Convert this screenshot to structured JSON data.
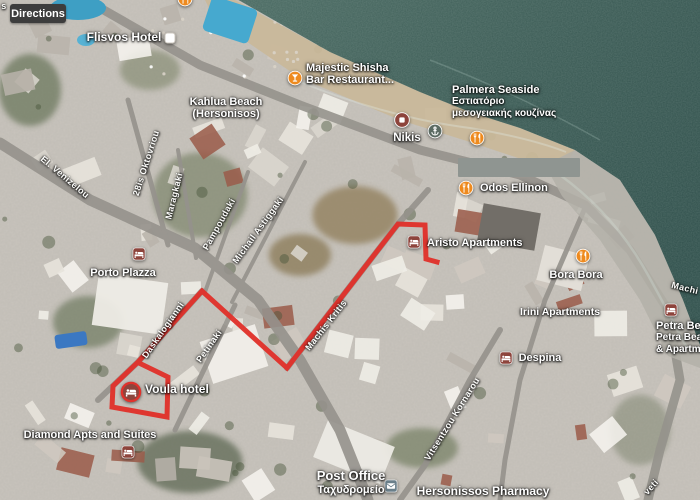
{
  "app": {
    "directions_button": "Directions"
  },
  "map": {
    "route": {
      "color": "#e0312b",
      "points": [
        [
          437,
          262
        ],
        [
          426,
          259
        ],
        [
          425,
          225
        ],
        [
          398,
          224
        ],
        [
          287,
          368
        ],
        [
          202,
          291
        ],
        [
          138,
          362
        ],
        [
          113,
          386
        ],
        [
          112,
          407
        ],
        [
          167,
          417
        ],
        [
          168,
          377
        ],
        [
          141,
          364
        ]
      ]
    },
    "redaction": {
      "x": 458,
      "y": 158,
      "w": 122,
      "h": 19
    },
    "pois": [
      {
        "id": "flisvos-hotel",
        "lines": [
          "Flisvos Hotel"
        ],
        "x": 124,
        "y": 31,
        "align": "center",
        "size": 12,
        "icon": "white-square-icon",
        "icon_x": 170,
        "icon_y": 38
      },
      {
        "id": "majestic-shisha-bar",
        "lines": [
          "Majestic Shisha",
          "Bar Restaurant..."
        ],
        "x": 306,
        "y": 62,
        "align": "left",
        "size": 11,
        "icon": "bar-icon",
        "icon_x": 295,
        "icon_y": 78
      },
      {
        "id": "kahlua-beach",
        "lines": [
          "Kahlua Beach",
          "(Hersonisos)"
        ],
        "x": 226,
        "y": 96,
        "align": "center",
        "size": 11
      },
      {
        "id": "palmera-seaside",
        "lines": [
          "Palmera Seaside",
          "Εστιατόριο",
          "μεσογειακής κουζίνας"
        ],
        "x": 452,
        "y": 84,
        "align": "left",
        "size": 11,
        "sub_from": 1,
        "icon": "restaurant-icon",
        "icon_x": 477,
        "icon_y": 138
      },
      {
        "id": "nikis",
        "lines": [
          "Nikis"
        ],
        "x": 407,
        "y": 132,
        "align": "center",
        "size": 11.5,
        "icon": "generic-poi-icon",
        "icon_x": 402,
        "icon_y": 120
      },
      {
        "id": "marina-poi",
        "lines": [],
        "x": 0,
        "y": 0,
        "icon": "anchor-poi-icon",
        "icon_x": 435,
        "icon_y": 131
      },
      {
        "id": "top-edge-poi",
        "lines": [],
        "x": 0,
        "y": 0,
        "icon": "restaurant-icon",
        "icon_x": 185,
        "icon_y": -1
      },
      {
        "id": "odos-ellinon",
        "lines": [
          "Odos Ellinon"
        ],
        "x": 480,
        "y": 182,
        "align": "left",
        "size": 11,
        "icon": "restaurant-icon",
        "icon_x": 466,
        "icon_y": 188
      },
      {
        "id": "aristo-apartments",
        "lines": [
          "Aristo Apartments"
        ],
        "x": 427,
        "y": 237,
        "align": "left",
        "size": 11,
        "icon": "lodging-icon",
        "icon_x": 414,
        "icon_y": 242
      },
      {
        "id": "porto-plazza",
        "lines": [
          "Porto Plazza"
        ],
        "x": 123,
        "y": 267,
        "align": "center",
        "size": 11,
        "icon": "lodging-icon",
        "icon_x": 139,
        "icon_y": 254
      },
      {
        "id": "bora-bora",
        "lines": [
          "Bora Bora"
        ],
        "x": 576,
        "y": 269,
        "align": "center",
        "size": 11,
        "icon": "restaurant-icon",
        "icon_x": 583,
        "icon_y": 256
      },
      {
        "id": "irini-apartments",
        "lines": [
          "Irini Apartments"
        ],
        "x": 560,
        "y": 307,
        "align": "center",
        "size": 10.5
      },
      {
        "id": "despina",
        "lines": [
          "Despina"
        ],
        "x": 540,
        "y": 352,
        "align": "center",
        "size": 11,
        "icon": "lodging-icon",
        "icon_x": 506,
        "icon_y": 358
      },
      {
        "id": "voula-hotel",
        "lines": [
          "Voula hotel"
        ],
        "x": 145,
        "y": 383,
        "align": "left",
        "size": 12,
        "icon": "lodging-highlight-icon",
        "icon_x": 131,
        "icon_y": 392
      },
      {
        "id": "diamond-apts-and-suites",
        "lines": [
          "Diamond Apts and Suites"
        ],
        "x": 90,
        "y": 429,
        "align": "center",
        "size": 11,
        "icon": "lodging-icon",
        "icon_x": 128,
        "icon_y": 452
      },
      {
        "id": "petra-beach-apartments",
        "lines": [
          "Petra Bea",
          "Petra Beach",
          "& Apartmen"
        ],
        "x": 656,
        "y": 320,
        "align": "left",
        "size": 11,
        "sub_from": 1,
        "icon": "lodging-icon",
        "icon_x": 671,
        "icon_y": 310
      },
      {
        "id": "post-office",
        "lines": [
          "Post Office",
          "Ταχυδρομείο"
        ],
        "x": 351,
        "y": 469,
        "align": "center",
        "size": 13,
        "sub_from": 1,
        "icon": "post-office-icon",
        "icon_x": 391,
        "icon_y": 486
      },
      {
        "id": "hersonissos-pharmacy",
        "lines": [
          "Hersonissos Pharmacy"
        ],
        "x": 483,
        "y": 485,
        "align": "center",
        "size": 12
      }
    ],
    "streets": [
      {
        "label": "s",
        "x": 4,
        "y": 6,
        "angle": 0
      },
      {
        "label": "El. Venizelou",
        "x": 65,
        "y": 177,
        "angle": 40
      },
      {
        "label": "28is Oktovriou",
        "x": 146,
        "y": 163,
        "angle": -72
      },
      {
        "label": "Maragkaki",
        "x": 174,
        "y": 196,
        "angle": -76
      },
      {
        "label": "Pampoudaki",
        "x": 219,
        "y": 224,
        "angle": -61
      },
      {
        "label": "Michail Astiggaki",
        "x": 258,
        "y": 230,
        "angle": -54
      },
      {
        "label": "Daskalogianni",
        "x": 163,
        "y": 330,
        "angle": -55
      },
      {
        "label": "Petinaki",
        "x": 209,
        "y": 346,
        "angle": -55
      },
      {
        "label": "Machis Kritis",
        "x": 326,
        "y": 325,
        "angle": -52
      },
      {
        "label": "Vitsentzou Kornarou",
        "x": 452,
        "y": 419,
        "angle": -58
      },
      {
        "label": "Machi",
        "x": 685,
        "y": 288,
        "angle": 14
      },
      {
        "label": "veti",
        "x": 651,
        "y": 487,
        "angle": -48
      }
    ]
  }
}
